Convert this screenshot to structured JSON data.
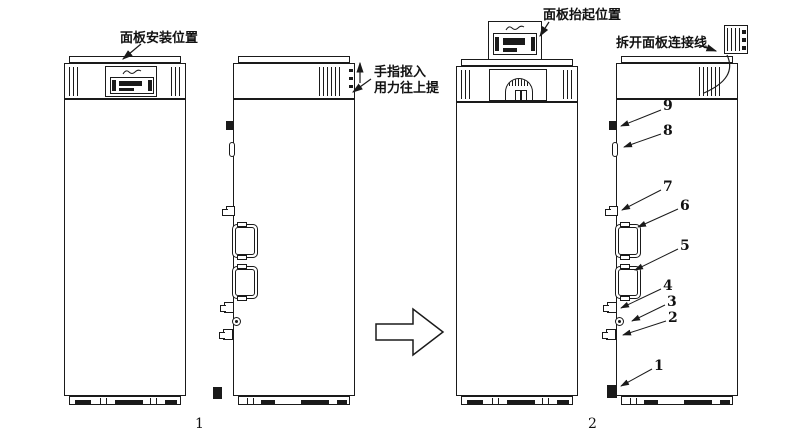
{
  "figure": {
    "annotations": {
      "panel_install_position": "面板安装位置",
      "finger_pull_line1": "手指抠入",
      "finger_pull_line2": "用力往上提",
      "panel_lift_position": "面板抬起位置",
      "disconnect_panel_wire": "拆开面板连接线"
    },
    "step_numbers": {
      "step1": "1",
      "step2": "2"
    },
    "part_callouts": [
      {
        "num": "1"
      },
      {
        "num": "2"
      },
      {
        "num": "3"
      },
      {
        "num": "4"
      },
      {
        "num": "5"
      },
      {
        "num": "6"
      },
      {
        "num": "7"
      },
      {
        "num": "8"
      },
      {
        "num": "9"
      }
    ],
    "colors": {
      "line": "#1a1a1a",
      "background": "#ffffff"
    }
  }
}
